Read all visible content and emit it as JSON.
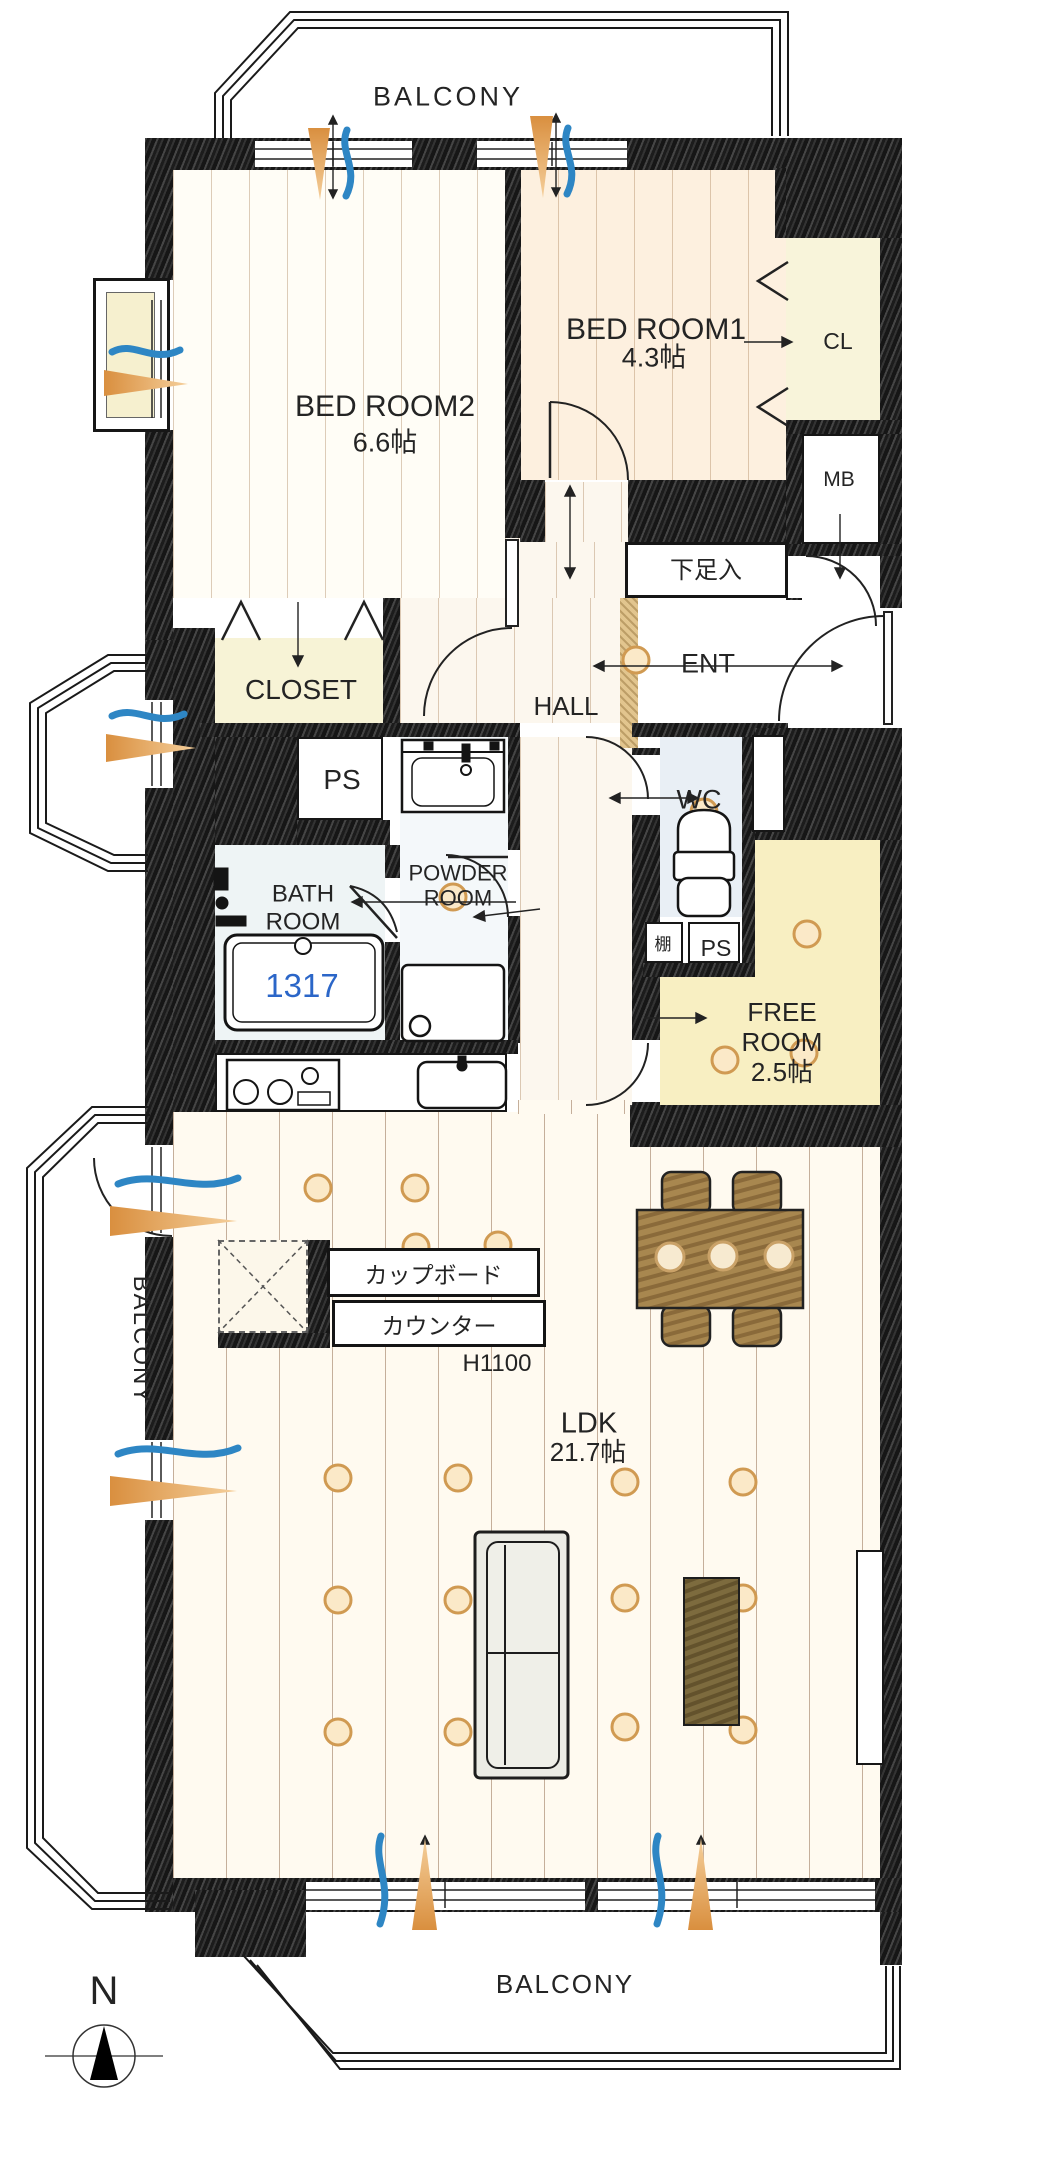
{
  "compass": {
    "north_label": "N"
  },
  "balconies": {
    "top": "BALCONY",
    "left": "BALCONY",
    "bottom": "BALCONY"
  },
  "rooms": {
    "bedroom2": {
      "name": "BED ROOM2",
      "size": "6.6帖"
    },
    "bedroom1": {
      "name": "BED ROOM1",
      "size": "4.3帖"
    },
    "closet_cl": {
      "name": "CL"
    },
    "meter_box": {
      "name": "MB"
    },
    "shoe_box": {
      "name": "下足入"
    },
    "entrance": {
      "name": "ENT"
    },
    "hall": {
      "name": "HALL"
    },
    "closet": {
      "name": "CLOSET"
    },
    "pipe_space_upper": {
      "name": "PS"
    },
    "powder_room": {
      "name": "POWDER ROOM"
    },
    "bath_room": {
      "name": "BATH ROOM",
      "bathtub_size": "1317"
    },
    "wc": {
      "name": "WC"
    },
    "shelf": {
      "name": "棚"
    },
    "pipe_space_lower": {
      "name": "PS"
    },
    "free_room": {
      "name": "FREE ROOM",
      "size": "2.5帖"
    },
    "ldk": {
      "name": "LDK",
      "size": "21.7帖"
    }
  },
  "kitchen": {
    "cupboard_label": "カップボード",
    "counter_label": "カウンター",
    "counter_height": "H1100"
  },
  "colors": {
    "wall": "#1c1c1c",
    "bathtub_number": "#2b66c8",
    "airflow_orange": "#dd9445",
    "airflow_blue": "#2e86c4",
    "downlight": "#d09a52"
  }
}
